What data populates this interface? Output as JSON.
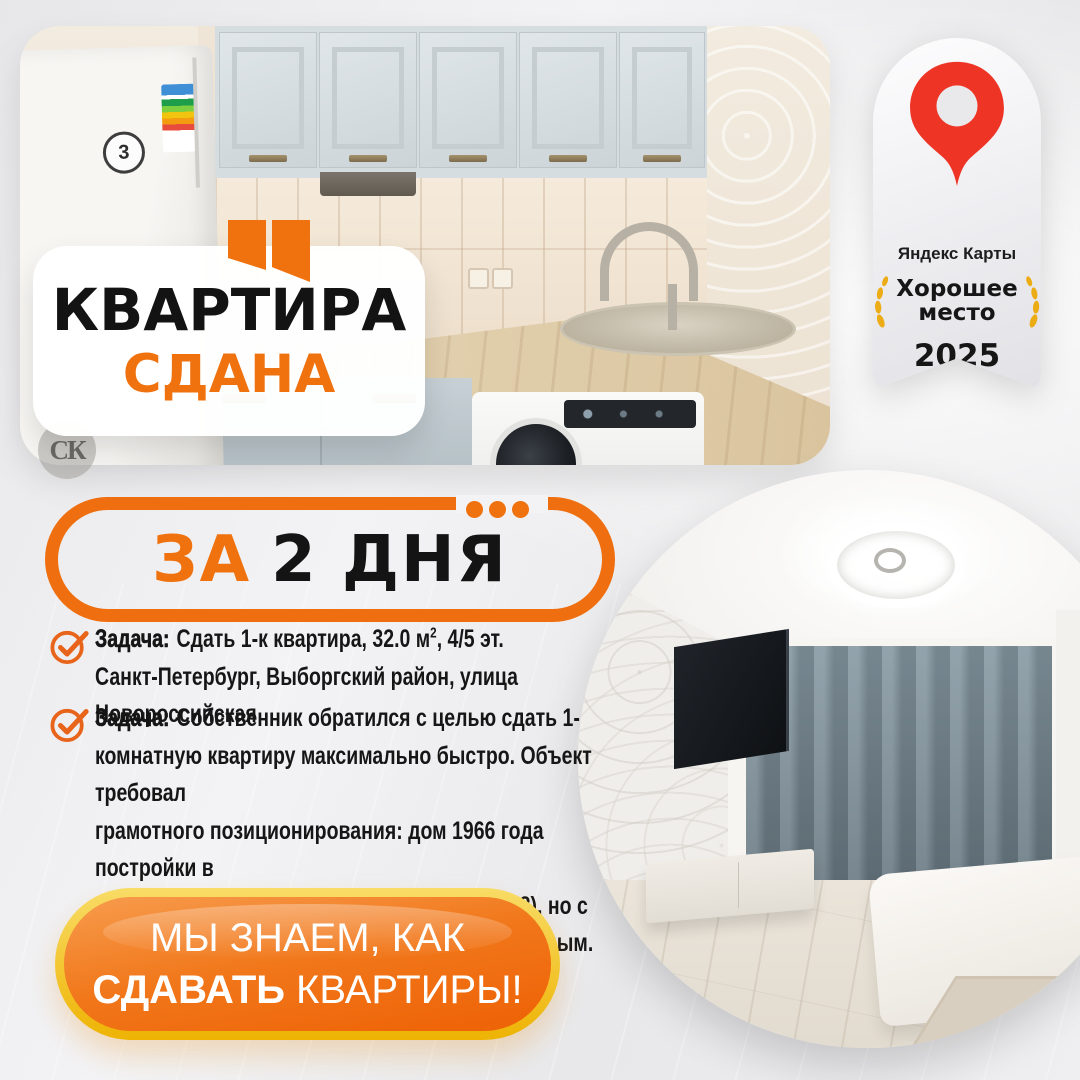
{
  "colors": {
    "orange": "#F0720E",
    "gold": "#F2BC0F",
    "pin_red": "#EE3425",
    "text_black": "#141414"
  },
  "photo_label": {
    "line1": "КВАРТИРА",
    "line2": "СДАНА"
  },
  "watermark": {
    "text": "СК"
  },
  "fridge": {
    "sticker": "3"
  },
  "badge": {
    "brand": "Яндекс Карты",
    "award_line1": "Хорошее",
    "award_line2": "место",
    "year": "2025"
  },
  "pill": {
    "highlight": "ЗА",
    "rest": "2 ДНЯ"
  },
  "bullets": {
    "first": {
      "label": "Задача:",
      "pre": "Сдать 1-к квартира, 32.0 м",
      "sup": "2",
      "post": ", 4/5 эт.",
      "line2": "Санкт-Петербург, Выборгский район, улица Новороссийская"
    },
    "second": {
      "label": "Задача:",
      "text": "Собственник обратился с целью сдать 1-\nкомнатную квартиру максимально быстро. Объект требовал\nграмотного позиционирования: дом 1966 года постройки в\nВыборгском районе (ул. Новороссийская, 38), но с\nотличным свежим ремонтом и всем необходимым."
    }
  },
  "cta": {
    "line1": "МЫ ЗНАЕМ, КАК",
    "line2_bold": "СДАВАТЬ",
    "line2_rest": "КВАРТИРЫ!"
  }
}
